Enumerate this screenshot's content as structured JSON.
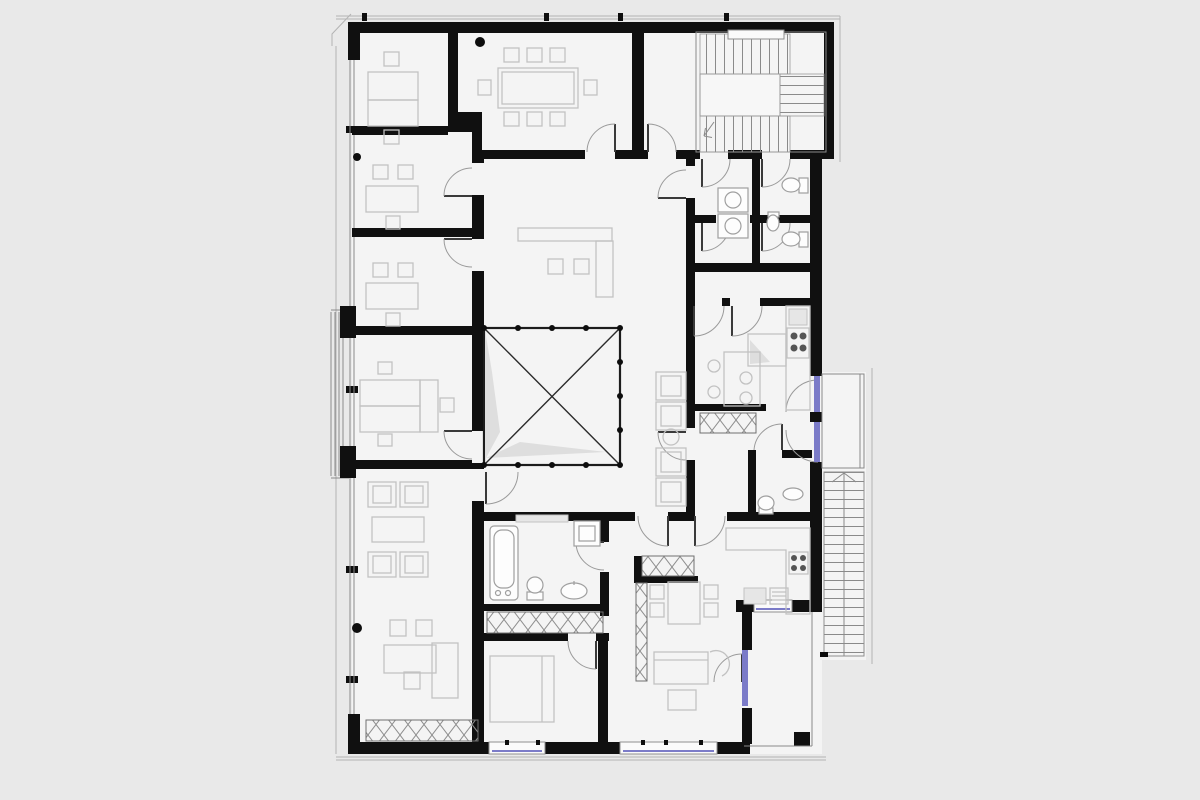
{
  "document": {
    "type": "architectural-floor-plan",
    "style": "black-and-white CAD storey plan",
    "visible_text": "none"
  },
  "palette": {
    "page": "#e9e9e9",
    "floor": "#f4f4f4",
    "wall": "#101010",
    "line": "#8a8a8a",
    "furn": "#c2c2c2",
    "fix": "#9f9f9f",
    "outer": "#b4b4b4",
    "glass": "#7b7bc8",
    "shadow": "#dedede"
  },
  "plan": {
    "rooms": [
      {
        "id": "office-1",
        "contents": "desk, task chairs"
      },
      {
        "id": "office-2",
        "contents": "desk, chairs"
      },
      {
        "id": "office-3",
        "contents": "desk, chairs"
      },
      {
        "id": "office-4",
        "contents": "double desk group"
      },
      {
        "id": "conference-room",
        "contents": "table, 8 chairs"
      },
      {
        "id": "lounge-office",
        "contents": "armchairs, coffee table, L-desk, wardrobe-hatch"
      },
      {
        "id": "reception-hall",
        "contents": "L-counter, 2 stools, waiting chairs, round table"
      },
      {
        "id": "stair-lobby",
        "contents": ""
      },
      {
        "id": "stairwell",
        "contents": "U-stair, landing"
      },
      {
        "id": "wc-block",
        "contents": "4 wc cabins, 2 back-to-back sinks, urinal, 2 wall-hung toilets"
      },
      {
        "id": "staff-kitchen",
        "contents": "oven, 4-burner hob, island, table, 4 stools"
      },
      {
        "id": "corridor",
        "contents": "wardrobe-hatch"
      },
      {
        "id": "small-wc",
        "contents": "toilet, sink"
      },
      {
        "id": "bathroom",
        "contents": "bathtub, toilet, sink, shower box"
      },
      {
        "id": "bedroom",
        "contents": "double bed, wardrobe-hatch"
      },
      {
        "id": "living-kitchen",
        "contents": "L-counter, hob, dining table, 4 chairs, sofa, coffee table, armchair, hatched shaft"
      },
      {
        "id": "balcony-left",
        "contents": "railing strip, 2 posts"
      },
      {
        "id": "balcony-right",
        "contents": "railing"
      },
      {
        "id": "terrace",
        "contents": "corner post, glazed door"
      },
      {
        "id": "exterior-stair",
        "contents": "straight flight, center handrail"
      }
    ],
    "void_opening": {
      "marker": "diagonal-cross",
      "railing_dots": 13
    },
    "stairs": {
      "interior": {
        "flights": 2,
        "landing": true,
        "side_treads": true
      },
      "exterior": {
        "treads": 20,
        "handrail": "center"
      }
    },
    "glazing": {
      "left_curtain_wall": true,
      "bottom_windows": 2,
      "right_balcony_doors": 2,
      "terrace_door": 1,
      "terrace_window": 1
    },
    "columns_dots": 3
  }
}
